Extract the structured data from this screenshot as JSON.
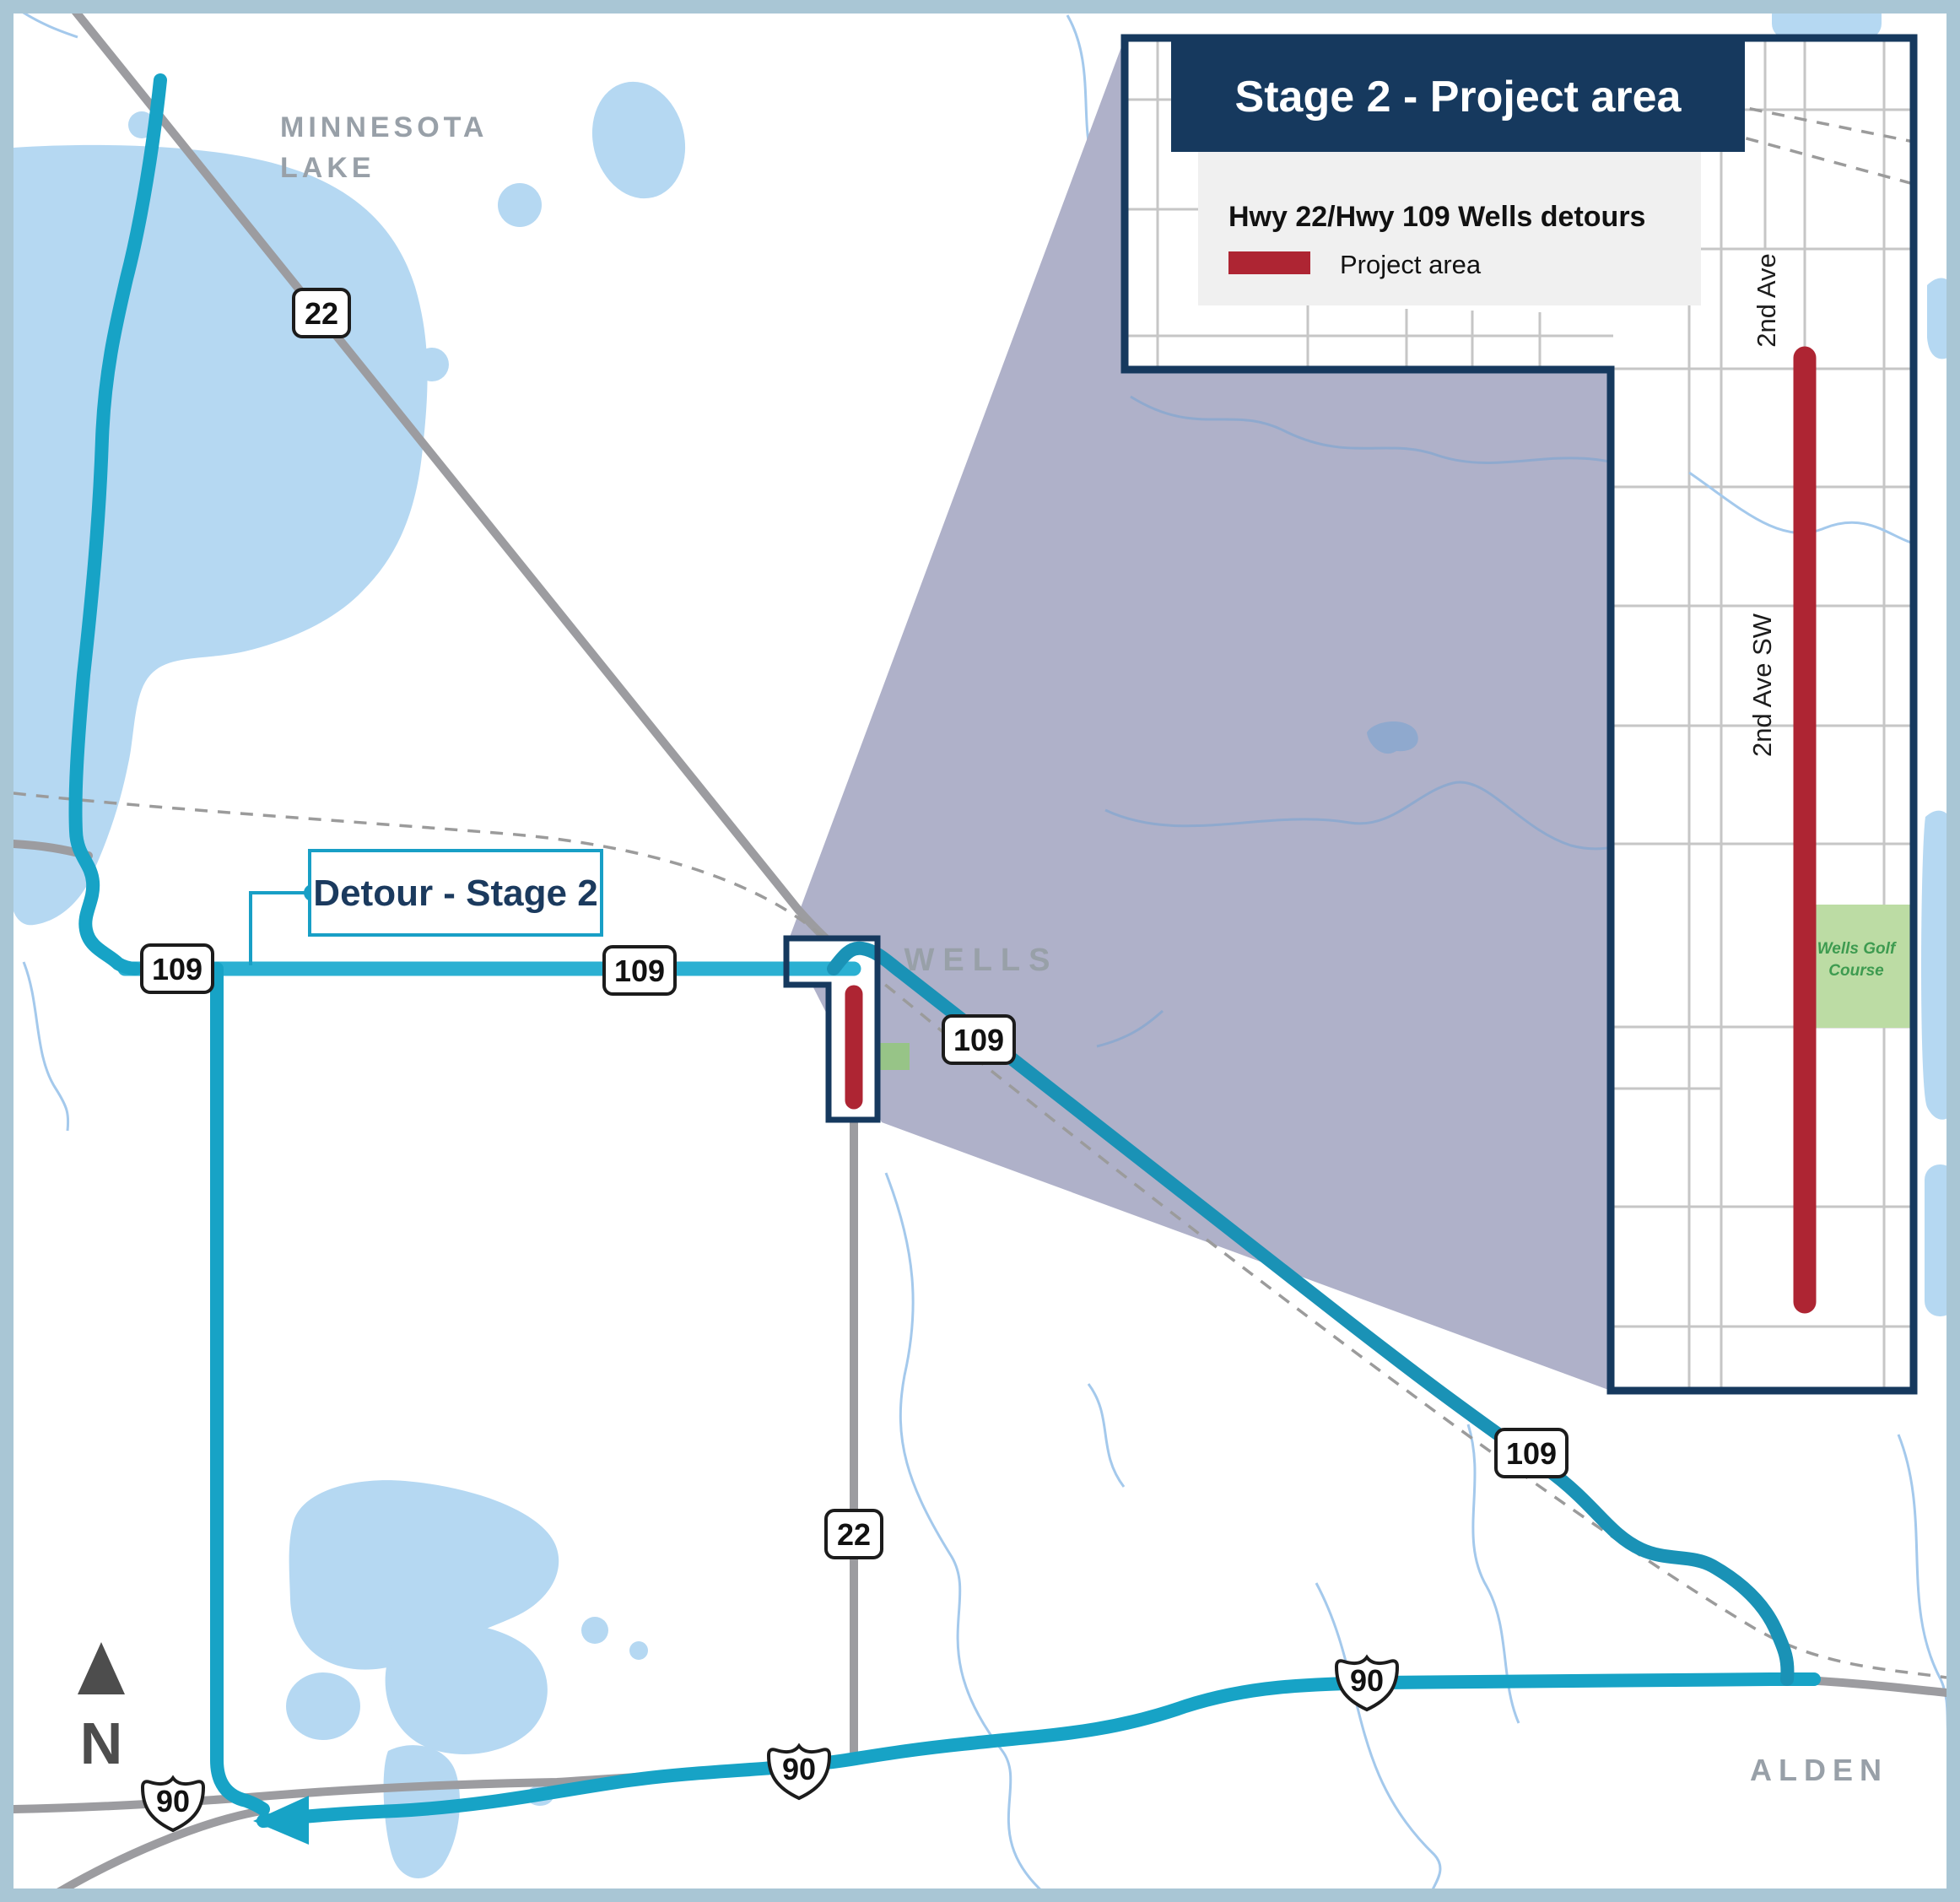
{
  "header": {
    "title": "Stage 2 - Project area"
  },
  "legend": {
    "title": "Hwy 22/Hwy 109 Wells detours",
    "item_label": "Project area"
  },
  "callout": {
    "label": "Detour - Stage 2"
  },
  "map_labels": {
    "minnesota_lake_line1": "MINNESOTA",
    "minnesota_lake_line2": "LAKE",
    "wells": "WELLS",
    "alden": "ALDEN",
    "north": "N"
  },
  "inset": {
    "street_label_1": "2nd Ave",
    "street_label_2": "2nd Ave SW",
    "golf_line1": "Wells Golf",
    "golf_line2": "Course"
  },
  "shields": {
    "hwy22_north": "22",
    "hwy22_south": "22",
    "hwy109_west": "109",
    "hwy109_mid": "109",
    "hwy109_wells": "109",
    "hwy109_southeast": "109",
    "i90_west": "90",
    "i90_center": "90",
    "i90_east": "90"
  },
  "colors": {
    "navy": "#16395e",
    "detour_teal": "#17a3c6",
    "detour_teal_light": "#2bb0d2",
    "detour_teal_dark": "#1a92b6",
    "project_red": "#ae2533",
    "wedge_purple": "#afb1c9",
    "lake_blue": "#b5d8f2",
    "golf_green": "#bcdca4",
    "frame_blue": "#a9c6d5",
    "road_gray": "#9c9ca0",
    "label_gray": "#98a0a8"
  }
}
